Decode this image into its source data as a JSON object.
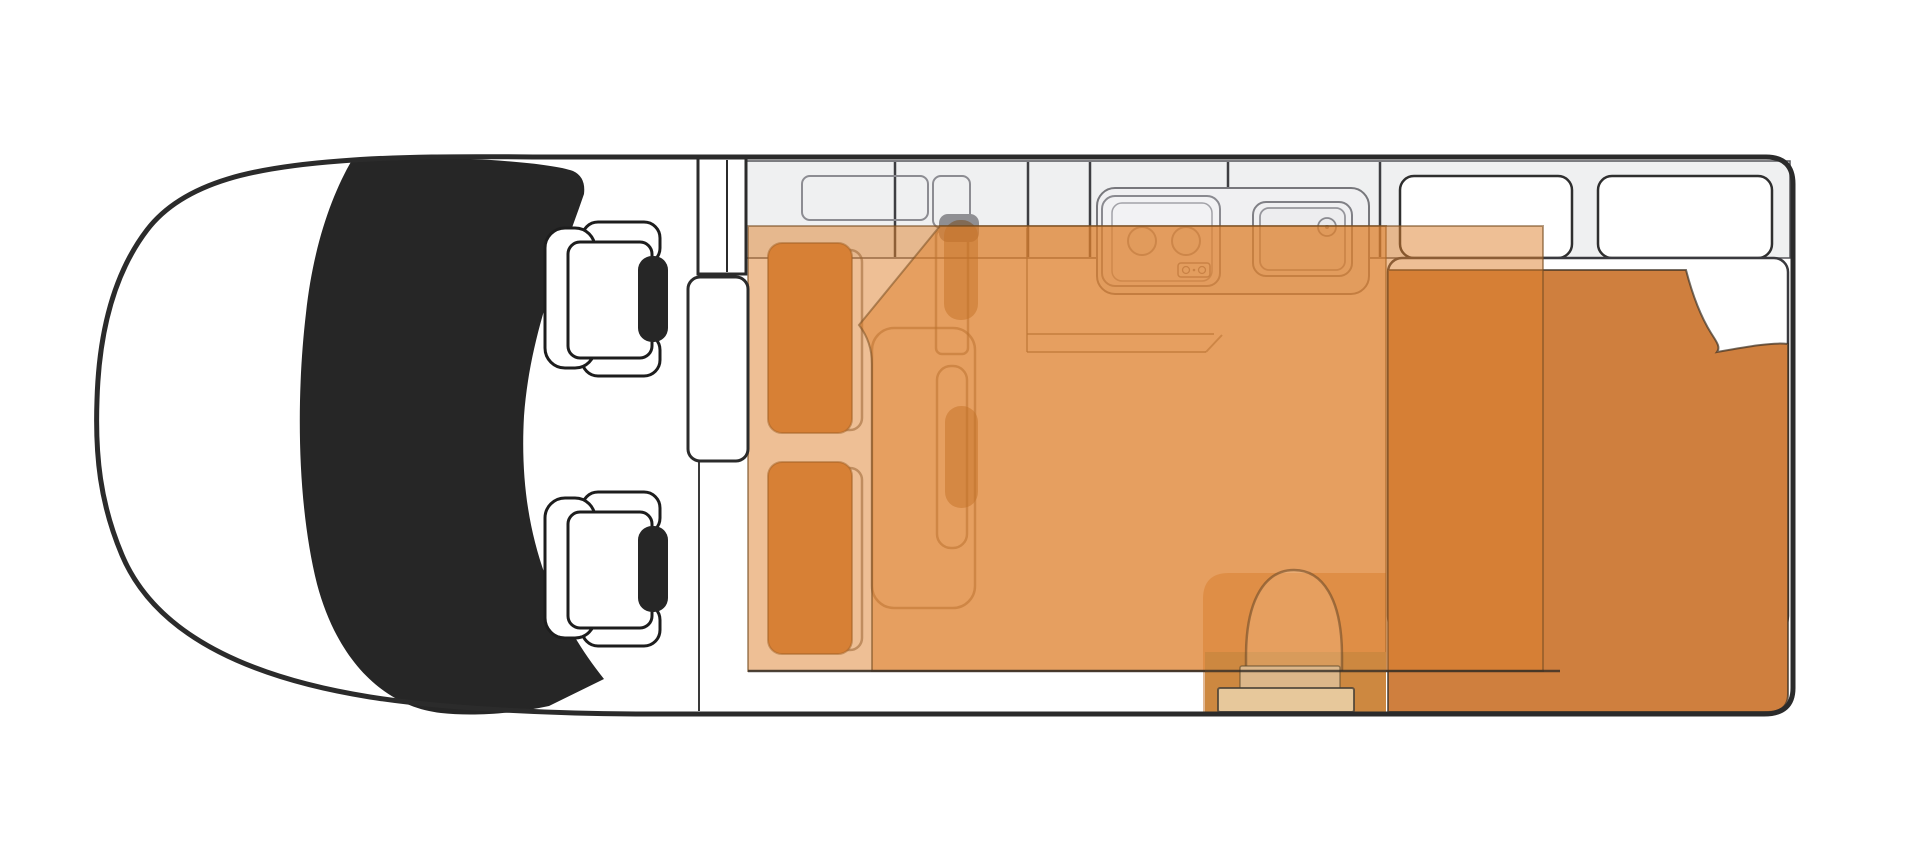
{
  "canvas": {
    "width": 1920,
    "height": 859,
    "background": "#ffffff"
  },
  "palette": {
    "body_outline": "#2b2b2b",
    "windshield": "#262626",
    "headrest": "#262626",
    "seat_fill": "#ffffff",
    "counter_band": "#eff0f1",
    "counter_module": "#f1f1f3",
    "window_fill": "#ffffff",
    "bed_overlay": "rgba(222,128,44,0.5)",
    "overlay_edge": "rgba(120,78,34,0.55)",
    "duvet": "#cf7f3e",
    "mattress": "#ffffff",
    "cushion": "#d0803f",
    "pedestal": "rgba(118,72,24,0.5)",
    "entry_fill": "rgba(198,116,44,0.5)",
    "door_well": "#cd8840",
    "step_light": "#e7c89b",
    "step_dark": "#dcb78a",
    "furniture_outline": "rgba(85,72,58,0.55)",
    "module_outline": "#7d7d83"
  },
  "floorplan": {
    "type": "campervan-top-view",
    "zones": [
      "cab-with-two-seats",
      "windshield",
      "divider-wall-with-wardrobe",
      "galley-kitchen-stove-sink",
      "dinette-benches-and-table",
      "bed-overlay-front",
      "bed-overlay-rear",
      "rear-bed-with-duvet",
      "entry-door-with-steps",
      "rear-windows"
    ]
  },
  "shapes": [
    {
      "kind": "rect",
      "name": "counter-band",
      "interactable": false,
      "attrs": {
        "x": 746,
        "y": 161,
        "width": 1044,
        "height": 97,
        "fill": "#eff0f1",
        "stroke": "#55555a",
        "stroke-width": 1.5
      }
    },
    {
      "kind": "line",
      "name": "band-divider-1",
      "interactable": false,
      "attrs": {
        "x1": 895,
        "y1": 162,
        "x2": 895,
        "y2": 257,
        "stroke": "#3e3e42",
        "stroke-width": 2.5
      }
    },
    {
      "kind": "line",
      "name": "band-divider-2",
      "interactable": false,
      "attrs": {
        "x1": 1028,
        "y1": 162,
        "x2": 1028,
        "y2": 257,
        "stroke": "#3e3e42",
        "stroke-width": 2.5
      }
    },
    {
      "kind": "line",
      "name": "band-divider-3",
      "interactable": false,
      "attrs": {
        "x1": 1090,
        "y1": 162,
        "x2": 1090,
        "y2": 257,
        "stroke": "#3e3e42",
        "stroke-width": 2.5
      }
    },
    {
      "kind": "line",
      "name": "band-divider-4",
      "interactable": false,
      "attrs": {
        "x1": 1228,
        "y1": 162,
        "x2": 1228,
        "y2": 257,
        "stroke": "#3e3e42",
        "stroke-width": 2.5
      }
    },
    {
      "kind": "line",
      "name": "band-divider-5",
      "interactable": false,
      "attrs": {
        "x1": 1380,
        "y1": 162,
        "x2": 1380,
        "y2": 257,
        "stroke": "#3e3e42",
        "stroke-width": 2.5
      }
    },
    {
      "kind": "rect",
      "name": "overhead-shelf-outline",
      "interactable": false,
      "attrs": {
        "x": 802,
        "y": 176,
        "width": 126,
        "height": 44,
        "rx": 8,
        "fill": "none",
        "stroke": "#8c8c92",
        "stroke-width": 2
      }
    },
    {
      "kind": "rect",
      "name": "table-column-outline",
      "interactable": false,
      "attrs": {
        "x": 933,
        "y": 176,
        "width": 37,
        "height": 52,
        "rx": 8,
        "fill": "none",
        "stroke": "#8c8c92",
        "stroke-width": 2
      }
    },
    {
      "kind": "rect",
      "name": "rear-window-1",
      "interactable": false,
      "attrs": {
        "x": 1400,
        "y": 176,
        "width": 172,
        "height": 82,
        "rx": 14,
        "fill": "#ffffff",
        "stroke": "#2f2f2f",
        "stroke-width": 2.5
      }
    },
    {
      "kind": "rect",
      "name": "rear-window-2",
      "interactable": false,
      "attrs": {
        "x": 1598,
        "y": 176,
        "width": 174,
        "height": 82,
        "rx": 14,
        "fill": "#ffffff",
        "stroke": "#2f2f2f",
        "stroke-width": 2.5
      }
    },
    {
      "kind": "rect",
      "name": "kitchen-counter-outline",
      "interactable": false,
      "attrs": {
        "x": 1097,
        "y": 188,
        "width": 272,
        "height": 106,
        "rx": 18,
        "fill": "#f0f0f2",
        "stroke": "#77777c",
        "stroke-width": 2
      }
    },
    {
      "kind": "line",
      "name": "kitchen-base-left-line",
      "interactable": false,
      "attrs": {
        "x1": 1027,
        "y1": 228,
        "x2": 1027,
        "y2": 352,
        "stroke": "rgba(90,85,80,0.6)",
        "stroke-width": 2
      }
    },
    {
      "kind": "line",
      "name": "kitchen-base-front-line-1",
      "interactable": false,
      "attrs": {
        "x1": 1027,
        "y1": 334,
        "x2": 1214,
        "y2": 334,
        "stroke": "rgba(90,85,80,0.6)",
        "stroke-width": 2
      }
    },
    {
      "kind": "line",
      "name": "kitchen-base-front-line-2",
      "interactable": false,
      "attrs": {
        "x1": 1027,
        "y1": 352,
        "x2": 1206,
        "y2": 352,
        "stroke": "rgba(90,85,80,0.6)",
        "stroke-width": 2
      }
    },
    {
      "kind": "line",
      "name": "kitchen-base-front-diagonal",
      "interactable": false,
      "attrs": {
        "x1": 1206,
        "y1": 352,
        "x2": 1222,
        "y2": 335,
        "stroke": "rgba(90,85,80,0.6)",
        "stroke-width": 2
      }
    },
    {
      "kind": "rect",
      "name": "stove-outer",
      "interactable": false,
      "attrs": {
        "x": 1102,
        "y": 196,
        "width": 118,
        "height": 90,
        "rx": 13,
        "fill": "#f2f2f4",
        "stroke": "#8a8a90",
        "stroke-width": 2
      }
    },
    {
      "kind": "rect",
      "name": "stove-inner",
      "interactable": false,
      "attrs": {
        "x": 1112,
        "y": 203,
        "width": 100,
        "height": 78,
        "rx": 10,
        "fill": "none",
        "stroke": "#a2a2a8",
        "stroke-width": 1.5
      }
    },
    {
      "kind": "circle",
      "name": "stove-burner-1",
      "interactable": false,
      "attrs": {
        "cx": 1142,
        "cy": 241,
        "r": 14,
        "fill": "#ececee",
        "stroke": "#9a9aa0",
        "stroke-width": 2
      }
    },
    {
      "kind": "circle",
      "name": "stove-burner-2",
      "interactable": false,
      "attrs": {
        "cx": 1186,
        "cy": 241,
        "r": 14,
        "fill": "#ececee",
        "stroke": "#9a9aa0",
        "stroke-width": 2
      }
    },
    {
      "kind": "rect",
      "name": "stove-knob-panel",
      "interactable": false,
      "attrs": {
        "x": 1178,
        "y": 263,
        "width": 32,
        "height": 14,
        "rx": 3,
        "fill": "#f4f4f6",
        "stroke": "#8a8a90",
        "stroke-width": 1.5
      }
    },
    {
      "kind": "circle",
      "name": "stove-knob-1",
      "interactable": false,
      "attrs": {
        "cx": 1186,
        "cy": 270,
        "r": 3.5,
        "fill": "none",
        "stroke": "#8a8a90",
        "stroke-width": 1.3
      }
    },
    {
      "kind": "circle",
      "name": "stove-knob-2",
      "interactable": false,
      "attrs": {
        "cx": 1202,
        "cy": 270,
        "r": 3.5,
        "fill": "none",
        "stroke": "#8a8a90",
        "stroke-width": 1.3
      }
    },
    {
      "kind": "circle",
      "name": "stove-knob-dot",
      "interactable": false,
      "attrs": {
        "cx": 1194,
        "cy": 270,
        "r": 1.3,
        "fill": "#8a8a90"
      }
    },
    {
      "kind": "rect",
      "name": "sink-outer",
      "interactable": false,
      "attrs": {
        "x": 1253,
        "y": 202,
        "width": 99,
        "height": 74,
        "rx": 13,
        "fill": "#f0f0f2",
        "stroke": "#808086",
        "stroke-width": 2
      }
    },
    {
      "kind": "rect",
      "name": "sink-inner",
      "interactable": false,
      "attrs": {
        "x": 1260,
        "y": 208,
        "width": 85,
        "height": 62,
        "rx": 9,
        "fill": "#ededef",
        "stroke": "#96969c",
        "stroke-width": 1.8
      }
    },
    {
      "kind": "circle",
      "name": "sink-faucet",
      "interactable": false,
      "attrs": {
        "cx": 1327,
        "cy": 227,
        "r": 9,
        "fill": "#e9e9eb",
        "stroke": "#8a8a90",
        "stroke-width": 1.8
      }
    },
    {
      "kind": "circle",
      "name": "sink-faucet-dot",
      "interactable": false,
      "attrs": {
        "cx": 1327,
        "cy": 227,
        "r": 2,
        "fill": "#8a8a90"
      }
    },
    {
      "kind": "rect",
      "name": "dinette-bench-1-outline",
      "interactable": false,
      "attrs": {
        "x": 782,
        "y": 250,
        "width": 80,
        "height": 180,
        "rx": 12,
        "fill": "none",
        "stroke": "rgba(85,72,58,0.55)",
        "stroke-width": 2.5
      }
    },
    {
      "kind": "rect",
      "name": "dinette-bench-2-outline",
      "interactable": false,
      "attrs": {
        "x": 782,
        "y": 468,
        "width": 80,
        "height": 182,
        "rx": 12,
        "fill": "none",
        "stroke": "rgba(85,72,58,0.55)",
        "stroke-width": 2.5
      }
    },
    {
      "kind": "rect",
      "name": "bench-platform-outline",
      "interactable": false,
      "attrs": {
        "x": 872,
        "y": 328,
        "width": 103,
        "height": 280,
        "rx": 22,
        "fill": "none",
        "stroke": "rgba(85,72,58,0.55)",
        "stroke-width": 2.5
      }
    },
    {
      "kind": "rect",
      "name": "table-column-lower-outline",
      "interactable": false,
      "attrs": {
        "x": 936,
        "y": 230,
        "width": 32,
        "height": 124,
        "rx": 6,
        "fill": "none",
        "stroke": "rgba(85,72,58,0.55)",
        "stroke-width": 2.5
      }
    },
    {
      "kind": "rect",
      "name": "table-outline",
      "interactable": false,
      "attrs": {
        "x": 937,
        "y": 366,
        "width": 30,
        "height": 182,
        "rx": 14,
        "fill": "none",
        "stroke": "rgba(85,72,58,0.55)",
        "stroke-width": 2.5
      }
    },
    {
      "kind": "rect",
      "name": "dinette-cushion-1",
      "interactable": false,
      "attrs": {
        "x": 768,
        "y": 243,
        "width": 84,
        "height": 190,
        "rx": 14,
        "fill": "#d0803f",
        "stroke": "rgba(100,66,30,0.5)",
        "stroke-width": 2
      }
    },
    {
      "kind": "rect",
      "name": "dinette-cushion-2",
      "interactable": false,
      "attrs": {
        "x": 768,
        "y": 462,
        "width": 84,
        "height": 192,
        "rx": 14,
        "fill": "#d0803f",
        "stroke": "rgba(100,66,30,0.5)",
        "stroke-width": 2
      }
    },
    {
      "kind": "rect",
      "name": "table-pedestal-cap",
      "interactable": false,
      "attrs": {
        "x": 939,
        "y": 214,
        "width": 40,
        "height": 28,
        "rx": 9,
        "fill": "#8f8f93"
      }
    },
    {
      "kind": "rect",
      "name": "table-pedestal-1",
      "interactable": false,
      "attrs": {
        "x": 944,
        "y": 220,
        "width": 34,
        "height": 100,
        "rx": 16,
        "fill": "rgba(118,72,24,0.5)"
      }
    },
    {
      "kind": "rect",
      "name": "table-pedestal-2",
      "interactable": false,
      "attrs": {
        "x": 945,
        "y": 406,
        "width": 33,
        "height": 102,
        "rx": 16,
        "fill": "rgba(118,72,24,0.5)"
      }
    },
    {
      "kind": "path",
      "name": "entry-door-area",
      "interactable": false,
      "attrs": {
        "d": "M 1229,573 L 1386,573 L 1386,712 L 1203,712 L 1203,599 Q 1203,573 1229,573 Z",
        "fill": "rgba(198,116,44,0.5)"
      }
    },
    {
      "kind": "rect",
      "name": "rear-bed-mattress",
      "interactable": false,
      "attrs": {
        "x": 1388,
        "y": 258,
        "width": 400,
        "height": 372,
        "rx": 14,
        "fill": "#ffffff",
        "stroke": "#3a3a3f",
        "stroke-width": 2.5
      }
    },
    {
      "kind": "path",
      "name": "rear-bed-duvet",
      "interactable": false,
      "attrs": {
        "d": "M 1388,270 L 1686,270 C 1693,297 1701,317 1711,333 C 1716,341 1721,347 1717,352 C 1745,347 1772,342 1788,344 L 1788,694 Q 1788,712 1768,712 L 1388,712 Z",
        "fill": "#cf7f3e",
        "stroke": "rgba(60,48,35,0.7)",
        "stroke-width": 2
      }
    },
    {
      "kind": "rect",
      "name": "bed-overlay-front",
      "interactable": false,
      "attrs": {
        "x": 748,
        "y": 226,
        "width": 638,
        "height": 445,
        "fill": "rgba(222,128,44,0.5)",
        "stroke": "rgba(120,78,34,0.55)",
        "stroke-width": 2
      }
    },
    {
      "kind": "path",
      "name": "bed-overlay-rear",
      "interactable": false,
      "attrs": {
        "d": "M 940,226 L 1543,226 L 1543,671 L 872,671 L 872,364 Q 872,342 859,325 Z",
        "fill": "rgba(222,128,44,0.5)",
        "stroke": "rgba(120,78,34,0.55)",
        "stroke-width": 2
      }
    },
    {
      "kind": "rect",
      "name": "door-well",
      "interactable": false,
      "attrs": {
        "x": 1205,
        "y": 652,
        "width": 181,
        "height": 60,
        "fill": "#cd8840"
      }
    },
    {
      "kind": "path",
      "name": "entry-door-arch",
      "interactable": false,
      "attrs": {
        "d": "M 1246,671 L 1246,656 C 1246,598 1266,570 1294,570 C 1322,570 1342,598 1342,656 L 1342,671",
        "fill": "rgba(255,225,185,0.22)",
        "stroke": "rgba(110,75,40,0.6)",
        "stroke-width": 2.5
      }
    },
    {
      "kind": "rect",
      "name": "entry-step-upper",
      "interactable": false,
      "attrs": {
        "x": 1240,
        "y": 666,
        "width": 100,
        "height": 24,
        "rx": 2,
        "fill": "#dcb78a",
        "stroke": "rgba(95,75,45,0.6)",
        "stroke-width": 1.5
      }
    },
    {
      "kind": "rect",
      "name": "entry-step-lower",
      "interactable": false,
      "attrs": {
        "x": 1218,
        "y": 688,
        "width": 136,
        "height": 24,
        "rx": 2,
        "fill": "#e7c89b",
        "stroke": "rgba(70,62,52,0.8)",
        "stroke-width": 2
      }
    },
    {
      "kind": "line",
      "name": "living-area-floor-line",
      "interactable": false,
      "attrs": {
        "x1": 748,
        "y1": 671,
        "x2": 1560,
        "y2": 671,
        "stroke": "rgba(50,44,38,0.8)",
        "stroke-width": 2.5
      }
    },
    {
      "kind": "line",
      "name": "cab-partition-line",
      "interactable": false,
      "attrs": {
        "x1": 699,
        "y1": 274,
        "x2": 699,
        "y2": 711,
        "stroke": "#3a3a3a",
        "stroke-width": 2
      }
    },
    {
      "kind": "rect",
      "name": "divider-wall",
      "interactable": false,
      "attrs": {
        "x": 698,
        "y": 158,
        "width": 48,
        "height": 116,
        "fill": "#ffffff",
        "stroke": "#2b2b2b",
        "stroke-width": 3
      }
    },
    {
      "kind": "line",
      "name": "divider-wall-inner-line",
      "interactable": false,
      "attrs": {
        "x1": 727,
        "y1": 160,
        "x2": 727,
        "y2": 272,
        "stroke": "#2b2b2b",
        "stroke-width": 2
      }
    },
    {
      "kind": "rect",
      "name": "wardrobe-cabinet",
      "interactable": false,
      "attrs": {
        "x": 688,
        "y": 277,
        "width": 60,
        "height": 184,
        "rx": 12,
        "fill": "#ffffff",
        "stroke": "#2b2b2b",
        "stroke-width": 3
      }
    },
    {
      "kind": "path",
      "name": "windshield",
      "interactable": false,
      "attrs": {
        "d": "M 352,160 C 430,154 546,161 573,171 Q 586,177 584,194 C 562,258 530,332 524,416 C 518,522 546,606 604,679 L 549,706 C 506,715 468,716 441,713 C 386,707 338,663 317,584 C 297,504 296,398 306,313 C 313,248 331,196 352,160 Z",
        "fill": "#262626"
      }
    },
    {
      "kind": "rect",
      "name": "seat-1-armrest-top",
      "interactable": false,
      "attrs": {
        "x": 582,
        "y": 222,
        "width": 78,
        "height": 42,
        "rx": 16,
        "fill": "#ffffff",
        "stroke": "#1d1d1d",
        "stroke-width": 3
      }
    },
    {
      "kind": "rect",
      "name": "seat-1-armrest-bottom",
      "interactable": false,
      "attrs": {
        "x": 582,
        "y": 334,
        "width": 78,
        "height": 42,
        "rx": 16,
        "fill": "#ffffff",
        "stroke": "#1d1d1d",
        "stroke-width": 3
      }
    },
    {
      "kind": "rect",
      "name": "seat-1-back",
      "interactable": false,
      "attrs": {
        "x": 545,
        "y": 228,
        "width": 50,
        "height": 140,
        "rx": 20,
        "fill": "#ffffff",
        "stroke": "#1d1d1d",
        "stroke-width": 3
      }
    },
    {
      "kind": "rect",
      "name": "seat-1-cushion",
      "interactable": false,
      "attrs": {
        "x": 568,
        "y": 242,
        "width": 84,
        "height": 116,
        "rx": 12,
        "fill": "#ffffff",
        "stroke": "#1d1d1d",
        "stroke-width": 3
      }
    },
    {
      "kind": "rect",
      "name": "seat-1-headrest",
      "interactable": false,
      "attrs": {
        "x": 638,
        "y": 256,
        "width": 30,
        "height": 86,
        "rx": 14,
        "fill": "#262626"
      }
    },
    {
      "kind": "rect",
      "name": "seat-2-armrest-top",
      "interactable": false,
      "attrs": {
        "x": 582,
        "y": 492,
        "width": 78,
        "height": 42,
        "rx": 16,
        "fill": "#ffffff",
        "stroke": "#1d1d1d",
        "stroke-width": 3
      }
    },
    {
      "kind": "rect",
      "name": "seat-2-armrest-bottom",
      "interactable": false,
      "attrs": {
        "x": 582,
        "y": 604,
        "width": 78,
        "height": 42,
        "rx": 16,
        "fill": "#ffffff",
        "stroke": "#1d1d1d",
        "stroke-width": 3
      }
    },
    {
      "kind": "rect",
      "name": "seat-2-back",
      "interactable": false,
      "attrs": {
        "x": 545,
        "y": 498,
        "width": 50,
        "height": 140,
        "rx": 20,
        "fill": "#ffffff",
        "stroke": "#1d1d1d",
        "stroke-width": 3
      }
    },
    {
      "kind": "rect",
      "name": "seat-2-cushion",
      "interactable": false,
      "attrs": {
        "x": 568,
        "y": 512,
        "width": 84,
        "height": 116,
        "rx": 12,
        "fill": "#ffffff",
        "stroke": "#1d1d1d",
        "stroke-width": 3
      }
    },
    {
      "kind": "rect",
      "name": "seat-2-headrest",
      "interactable": false,
      "attrs": {
        "x": 638,
        "y": 526,
        "width": 30,
        "height": 86,
        "rx": 14,
        "fill": "#262626"
      }
    },
    {
      "kind": "path",
      "name": "van-body-outline",
      "interactable": false,
      "attrs": {
        "d": "M 560,157 L 1766,157 Q 1793,157 1793,184 L 1793,688 Q 1793,714 1764,714 L 650,714 C 545,714 440,708 370,697 C 270,681 160,645 122,555 C 100,503 95,455 97,400 C 99,330 115,272 147,230 C 185,180 260,167 340,161 C 415,155 495,157 560,157 Z",
        "fill": "none",
        "stroke": "#2b2b2b",
        "stroke-width": 5
      }
    }
  ]
}
